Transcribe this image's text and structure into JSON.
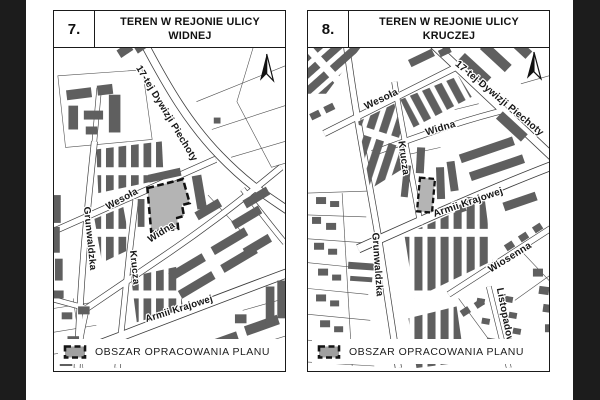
{
  "document": {
    "background": "#ffffff",
    "film_border_color": "#1c1c1c"
  },
  "panels": [
    {
      "number": "7.",
      "title_line1": "TEREN W REJONIE ULICY",
      "title_line2": "WIDNEJ",
      "streets": {
        "dywizji": "17-tej Dywizji Piechoty",
        "wesola": "Wesoła",
        "widna": "Widna",
        "grunwaldzka": "Grunwaldzka",
        "krucza": "Krucza",
        "armii": "Armii Krajowej"
      },
      "legend_label": "OBSZAR OPRACOWANIA PLANU"
    },
    {
      "number": "8.",
      "title_line1": "TEREN W REJONIE ULICY",
      "title_line2": "KRUCZEJ",
      "streets": {
        "dywizji": "17-tej Dywizji Piechoty",
        "wesola": "Wesoła",
        "widna": "Widna",
        "grunwaldzka": "Grunwaldzka",
        "krucza": "Krucza",
        "armii": "Armii Krajowej",
        "wiosenna": "Wiosenna",
        "listopadowa": "Listopadowa"
      },
      "legend_label": "OBSZAR OPRACOWANIA PLANU"
    }
  ],
  "icons": {
    "north_arrow": "north-arrow-icon",
    "plan_area_swatch": "plan-area-swatch-icon"
  },
  "colors": {
    "building": "#5f5f5f",
    "plan_area_fill": "#b4b4b4",
    "plan_area_border": "#111111",
    "road_edge": "#3d3d3d",
    "parcel_line": "#4f4f4f",
    "frame": "#1a1a1a"
  }
}
